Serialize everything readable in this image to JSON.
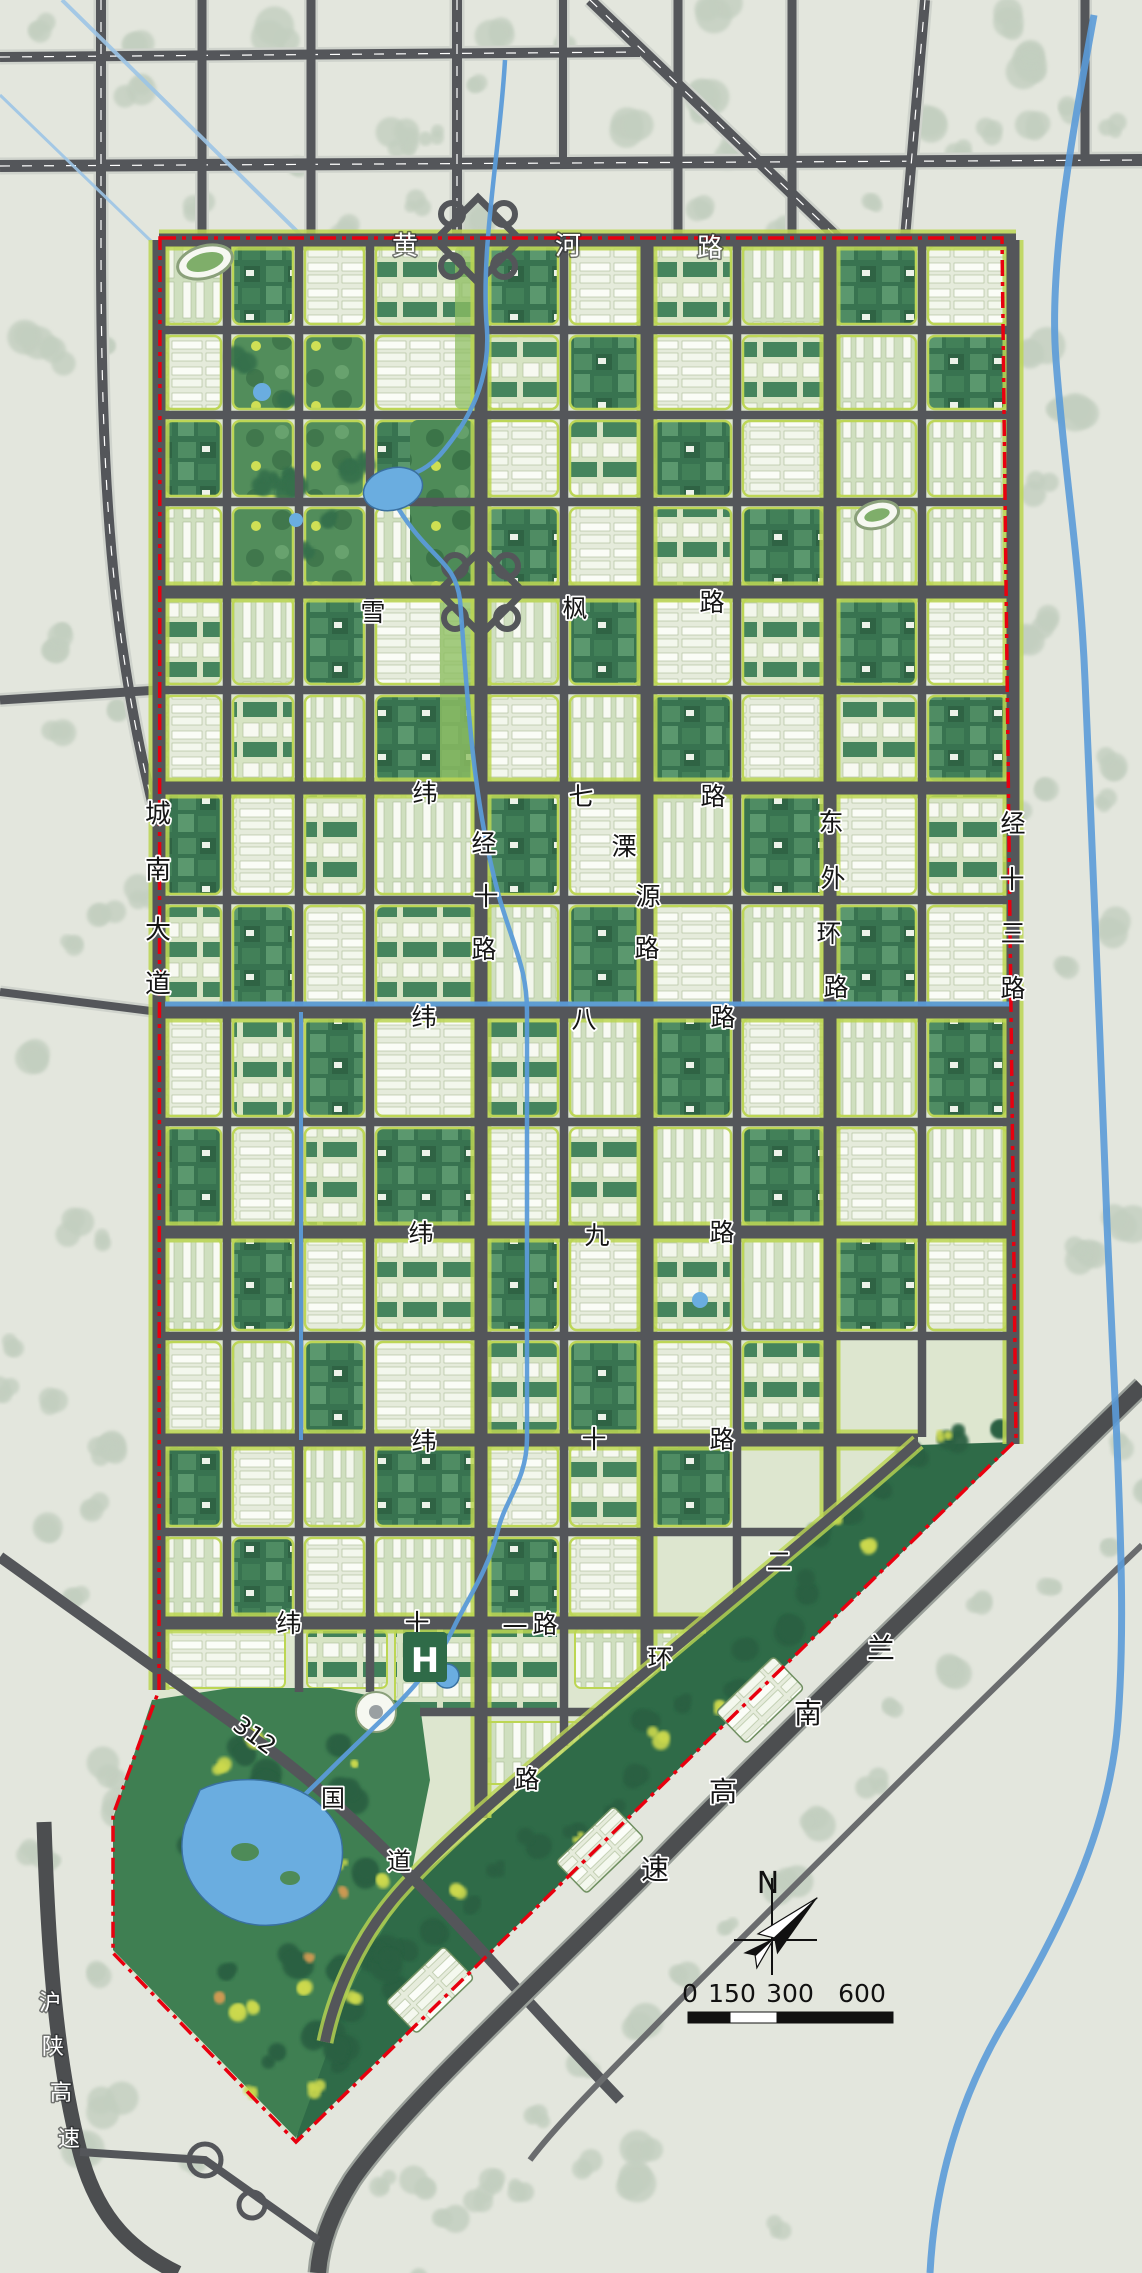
{
  "map_type": "urban-master-plan",
  "colors": {
    "background": "#e3e6dd",
    "outside_tree": "#c3cfc0",
    "road": "#54565a",
    "road_casing": "#cfd3cc",
    "green_edge": "#bcd653",
    "boundary_red": "#e8000f",
    "water": "#5b9bd8",
    "lake": "#6aade0",
    "park_dark": "#3f7f52",
    "belt_dark": "#2f6b48",
    "label_black": "#151515",
    "label_white": "#ffffff"
  },
  "road_labels": [
    {
      "id": "huanghe-road",
      "name": "黄河路",
      "color": "white",
      "size": 26,
      "chars": [
        {
          "c": "黄",
          "x": 405,
          "y": 245
        },
        {
          "c": "河",
          "x": 568,
          "y": 245
        },
        {
          "c": "路",
          "x": 710,
          "y": 247
        }
      ]
    },
    {
      "id": "xuefeng-road",
      "name": "雪枫路",
      "color": "black",
      "size": 25,
      "chars": [
        {
          "c": "雪",
          "x": 373,
          "y": 612
        },
        {
          "c": "枫",
          "x": 575,
          "y": 608
        },
        {
          "c": "路",
          "x": 712,
          "y": 602
        }
      ]
    },
    {
      "id": "weiqi-road",
      "name": "纬七路",
      "color": "black",
      "size": 25,
      "chars": [
        {
          "c": "纬",
          "x": 425,
          "y": 793
        },
        {
          "c": "七",
          "x": 581,
          "y": 796
        },
        {
          "c": "路",
          "x": 713,
          "y": 796
        }
      ]
    },
    {
      "id": "weiba-road",
      "name": "纬八路",
      "color": "black",
      "size": 25,
      "chars": [
        {
          "c": "纬",
          "x": 424,
          "y": 1017
        },
        {
          "c": "八",
          "x": 584,
          "y": 1019
        },
        {
          "c": "路",
          "x": 723,
          "y": 1017
        }
      ]
    },
    {
      "id": "weijiu-road",
      "name": "纬九路",
      "color": "black",
      "size": 25,
      "chars": [
        {
          "c": "纬",
          "x": 421,
          "y": 1233
        },
        {
          "c": "九",
          "x": 597,
          "y": 1235
        },
        {
          "c": "路",
          "x": 722,
          "y": 1232
        }
      ]
    },
    {
      "id": "weishi-road",
      "name": "纬十路",
      "color": "black",
      "size": 25,
      "chars": [
        {
          "c": "纬",
          "x": 424,
          "y": 1441
        },
        {
          "c": "十",
          "x": 594,
          "y": 1439
        },
        {
          "c": "路",
          "x": 722,
          "y": 1439
        }
      ]
    },
    {
      "id": "weishiyi-road",
      "name": "纬十一路",
      "color": "black",
      "size": 25,
      "chars": [
        {
          "c": "纬",
          "x": 289,
          "y": 1623
        },
        {
          "c": "十",
          "x": 417,
          "y": 1623
        },
        {
          "c": "一",
          "x": 515,
          "y": 1627
        },
        {
          "c": "路",
          "x": 545,
          "y": 1624
        }
      ]
    },
    {
      "id": "chengnan-avenue",
      "name": "城南大道",
      "color": "black",
      "size": 26,
      "chars": [
        {
          "c": "城",
          "x": 158,
          "y": 813
        },
        {
          "c": "南",
          "x": 158,
          "y": 869
        },
        {
          "c": "大",
          "x": 158,
          "y": 929
        },
        {
          "c": "道",
          "x": 158,
          "y": 983
        }
      ]
    },
    {
      "id": "jingshi-road",
      "name": "经十路",
      "color": "black",
      "size": 25,
      "chars": [
        {
          "c": "经",
          "x": 484,
          "y": 843
        },
        {
          "c": "十",
          "x": 486,
          "y": 896
        },
        {
          "c": "路",
          "x": 484,
          "y": 949
        }
      ]
    },
    {
      "id": "liyuan-road",
      "name": "溧源路",
      "color": "black",
      "size": 25,
      "chars": [
        {
          "c": "溧",
          "x": 624,
          "y": 846
        },
        {
          "c": "源",
          "x": 648,
          "y": 896
        },
        {
          "c": "路",
          "x": 647,
          "y": 948
        }
      ]
    },
    {
      "id": "dongwaihuan-road",
      "name": "东外环路",
      "color": "black",
      "size": 25,
      "chars": [
        {
          "c": "东",
          "x": 831,
          "y": 822
        },
        {
          "c": "外",
          "x": 833,
          "y": 878
        },
        {
          "c": "环",
          "x": 829,
          "y": 933
        },
        {
          "c": "路",
          "x": 836,
          "y": 987
        }
      ]
    },
    {
      "id": "jingshisan-road",
      "name": "经十三路",
      "color": "black",
      "size": 25,
      "chars": [
        {
          "c": "经",
          "x": 1013,
          "y": 823
        },
        {
          "c": "十",
          "x": 1012,
          "y": 879
        },
        {
          "c": "三",
          "x": 1013,
          "y": 933
        },
        {
          "c": "路",
          "x": 1013,
          "y": 988
        }
      ]
    },
    {
      "id": "erhuan-road",
      "name": "二环路",
      "color": "black",
      "size": 25,
      "chars": [
        {
          "c": "二",
          "x": 779,
          "y": 1561
        },
        {
          "c": "环",
          "x": 660,
          "y": 1658
        },
        {
          "c": "路",
          "x": 527,
          "y": 1779
        }
      ]
    },
    {
      "id": "lannan-expressway",
      "name": "兰南高速",
      "color": "black",
      "size": 28,
      "chars": [
        {
          "c": "兰",
          "x": 881,
          "y": 1648
        },
        {
          "c": "南",
          "x": 808,
          "y": 1713
        },
        {
          "c": "高",
          "x": 723,
          "y": 1791
        },
        {
          "c": "速",
          "x": 655,
          "y": 1869
        }
      ]
    },
    {
      "id": "g312-national-road",
      "name": "312国道",
      "color": "black",
      "size": 24,
      "chars": [
        {
          "c": "312",
          "x": 255,
          "y": 1735,
          "rotate": 36
        },
        {
          "c": "国",
          "x": 333,
          "y": 1798
        },
        {
          "c": "道",
          "x": 399,
          "y": 1861
        }
      ]
    },
    {
      "id": "hushaan-expressway",
      "name": "沪陕高速",
      "color": "white",
      "size": 22,
      "chars": [
        {
          "c": "沪",
          "x": 50,
          "y": 2002
        },
        {
          "c": "陕",
          "x": 53,
          "y": 2046
        },
        {
          "c": "高",
          "x": 61,
          "y": 2092
        },
        {
          "c": "速",
          "x": 69,
          "y": 2138
        }
      ]
    }
  ],
  "landmarks": [
    {
      "id": "hospital-marker",
      "text": "H",
      "x": 425,
      "y": 1672
    }
  ],
  "compass": {
    "label": "N",
    "cx": 772,
    "cy": 1940
  },
  "scale_bar": {
    "ticks": [
      {
        "label": "0",
        "x": 690
      },
      {
        "label": "150",
        "x": 732
      },
      {
        "label": "300",
        "x": 790
      },
      {
        "label": "600",
        "x": 862
      }
    ],
    "x": 688,
    "y": 2012,
    "w": 205,
    "h": 11,
    "white_seg": [
      730,
      777
    ]
  }
}
